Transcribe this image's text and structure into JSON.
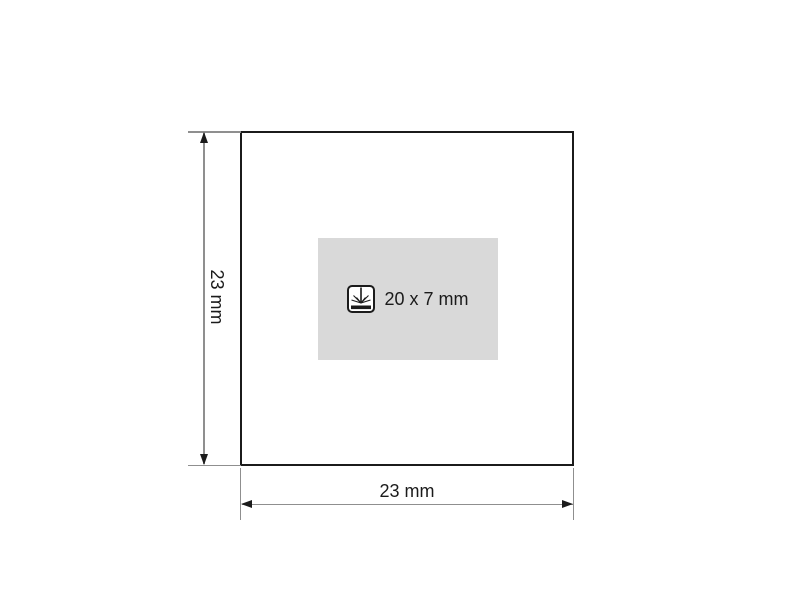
{
  "diagram": {
    "type": "imprint-area-specification-drawing",
    "dimensions": {
      "height": {
        "label": "23 mm"
      },
      "width": {
        "label": "23 mm"
      }
    },
    "print_area": {
      "size_label": "20 x 7 mm",
      "icon": "laser-engraving-icon",
      "fill_color": "#d9d9d9"
    },
    "colors": {
      "outline": "#1b1b1b",
      "dimension_line": "#8f8f8f",
      "text": "#1b1b1b",
      "background": "#ffffff"
    }
  }
}
